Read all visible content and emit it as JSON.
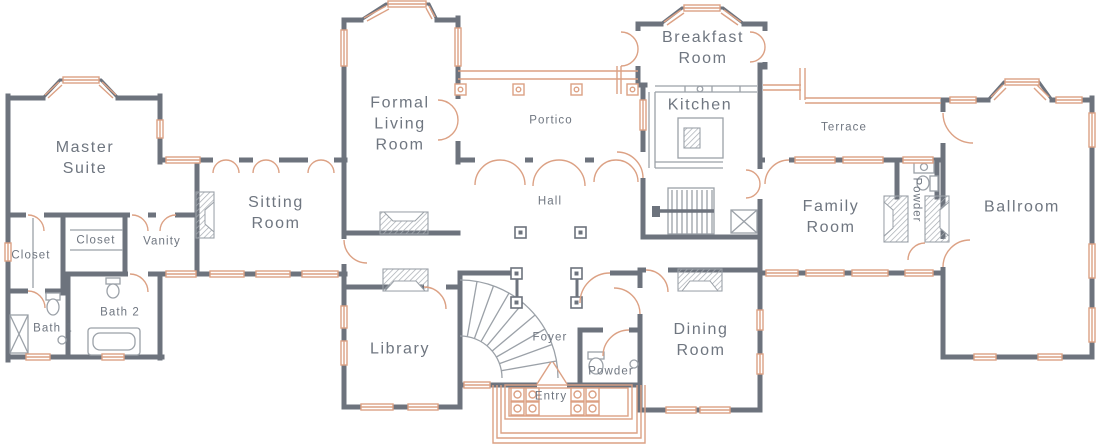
{
  "plan": {
    "title": "Main level floor plan",
    "rooms": {
      "master_suite": "Master\nSuite",
      "closet_left": "Closet",
      "closet_middle": "Closet",
      "vanity": "Vanity",
      "bath_1": "Bath 1",
      "bath_2": "Bath 2",
      "sitting_room": "Sitting\nRoom",
      "formal_living_room": "Formal\nLiving\nRoom",
      "portico": "Portico",
      "hall": "Hall",
      "library": "Library",
      "foyer": "Foyer",
      "powder_foyer": "Powder",
      "entry": "Entry",
      "dining_room": "Dining\nRoom",
      "breakfast_room": "Breakfast\nRoom",
      "kitchen": "Kitchen",
      "terrace": "Terrace",
      "family_room": "Family\nRoom",
      "powder_family": "Powder",
      "ballroom": "Ballroom"
    },
    "colors": {
      "wall": "#6d737d",
      "accent": "#dca184",
      "fixture": "#9ba1a8",
      "text": "#6f7680"
    }
  }
}
